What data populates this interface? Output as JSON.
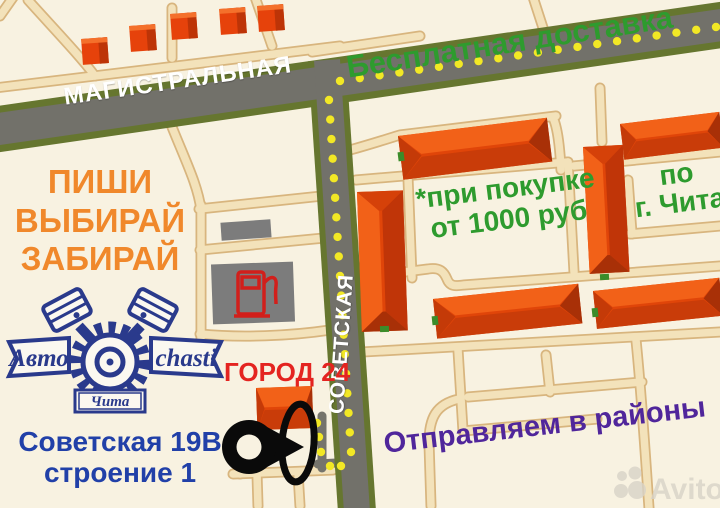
{
  "map": {
    "streets": {
      "magistralnaya": "МАГИСТРАЛЬНАЯ",
      "sovetskaya": "СОВЕТСКАЯ"
    },
    "promo": {
      "free_delivery": "Бесплатная доставка",
      "condition_line1": "*при покупке",
      "condition_line2": "от 1000 руб",
      "area_line1": "по",
      "area_line2": "г. Чита"
    },
    "cta": {
      "line1": "ПИШИ",
      "line2": "ВЫБИРАЙ",
      "line3": "ЗАБИРАЙ"
    },
    "landmark_label": "ГОРОД 24",
    "address": {
      "line1": "Советская 19В",
      "line2": "строение 1"
    },
    "shipping": "Отправляем в районы"
  },
  "logo": {
    "banner_left": "Авто",
    "banner_right": "chasti",
    "city_banner": "Чита"
  },
  "watermark": {
    "brand": "Avito"
  },
  "palette": {
    "background_cream": "#F8F2E1",
    "road_gray": "#72716A",
    "road_border_olive": "#66762F",
    "route_dot_yellow": "#F2E825",
    "thin_road_fill": "#F3E2BA",
    "thin_road_border": "#D8B57E",
    "building_orange": "#E04509",
    "building_dark": "#A83007",
    "text_green": "#2E9B2E",
    "text_orange": "#F0882B",
    "text_red": "#E42420",
    "text_navy": "#2140A8",
    "text_purple": "#50269B",
    "logo_navy": "#2A3A8C",
    "pin_black": "#0A0A0A",
    "pump_red": "#D21F1B"
  }
}
